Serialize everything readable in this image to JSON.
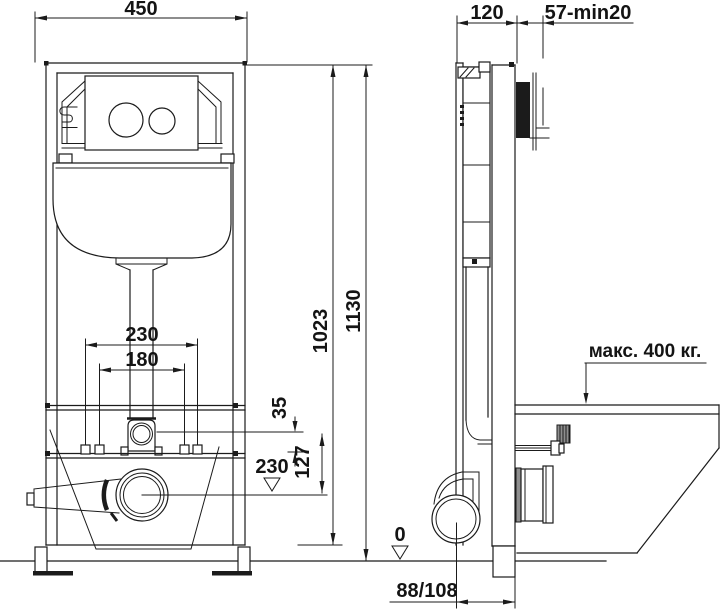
{
  "drawing_type": "installation-frame-technical-drawing",
  "colors": {
    "line": "#1b1b1b",
    "background": "#ffffff",
    "section_fill": "#1b1b1b"
  },
  "front_view": {
    "dim_frame_width": "450",
    "dim_bolt_spacing_outer": "230",
    "dim_bolt_spacing_inner": "180",
    "dim_flush_to_bolts": "35",
    "dim_flush_to_outlet": "127",
    "level_outlet": "230",
    "dim_height_frame": "1023",
    "dim_height_overall": "1130"
  },
  "side_view": {
    "dim_frame_depth": "120",
    "dim_plate_depth": "57-min20",
    "load_label": "макс. 400 кг.",
    "level_floor": "0",
    "dim_wall_to_drain": "88/108"
  }
}
